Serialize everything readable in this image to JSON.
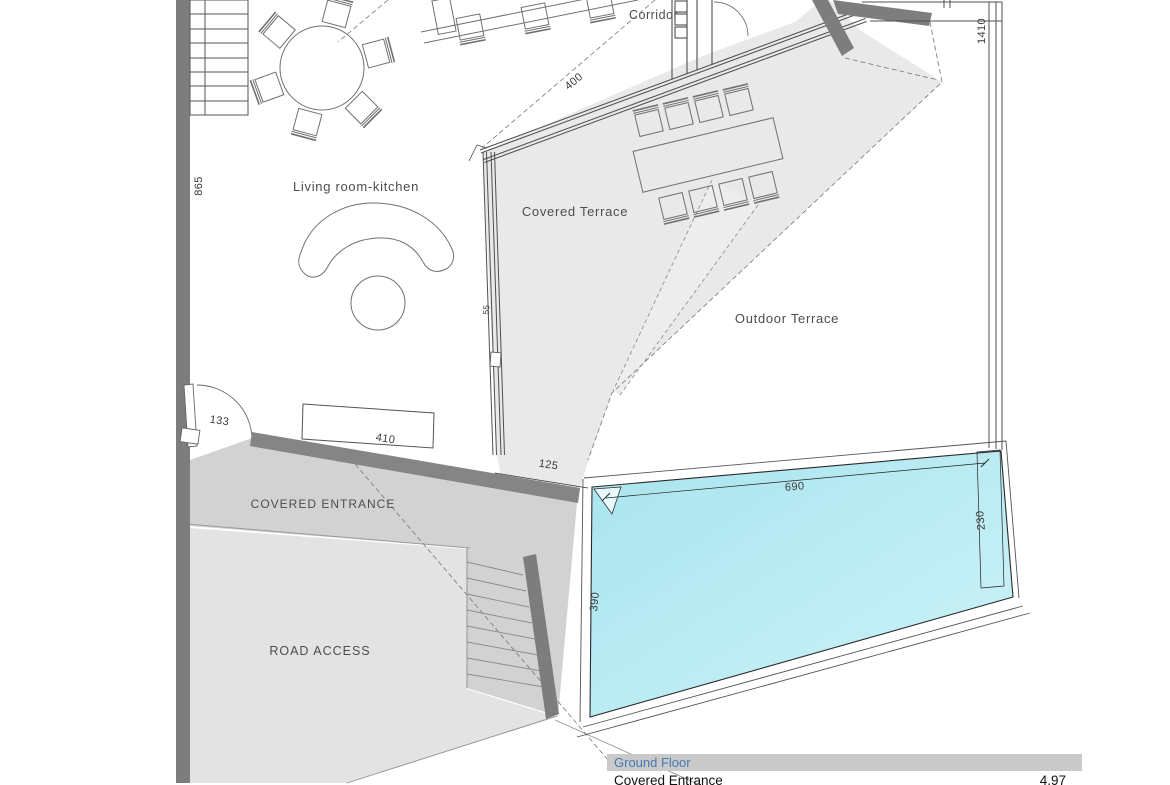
{
  "plan": {
    "rooms": {
      "living_room_kitchen": "Living room-kitchen",
      "covered_terrace": "Covered Terrace",
      "outdoor_terrace": "Outdoor Terrace",
      "corridor": "Corridor",
      "covered_entrance": "COVERED ENTRANCE",
      "road_access": "ROAD ACCESS"
    },
    "dims": {
      "left_wall": "865",
      "right_boundary": "1410",
      "glass_diagonal": "400",
      "terrace_wall": "55",
      "entrance_door": "133",
      "entrance_wall": "410",
      "terrace_gap": "125",
      "pool_length": "690",
      "pool_width": "230",
      "pool_side": "390"
    },
    "colors": {
      "pool_gradient_start": "#a9e4ee",
      "pool_gradient_end": "#cdf3f8",
      "covered_terrace_fill": "#e9e9e9",
      "covered_entrance_fill": "#d2d2d2",
      "road_access_fill": "#e3e3e3",
      "wall_dark": "#7d7d7d",
      "table_header_bg": "#c9c9c9",
      "table_header_text": "#4779b4"
    }
  },
  "area_table": {
    "header": "Ground Floor",
    "row_label": "Covered Entrance",
    "row_value": "4.97"
  }
}
